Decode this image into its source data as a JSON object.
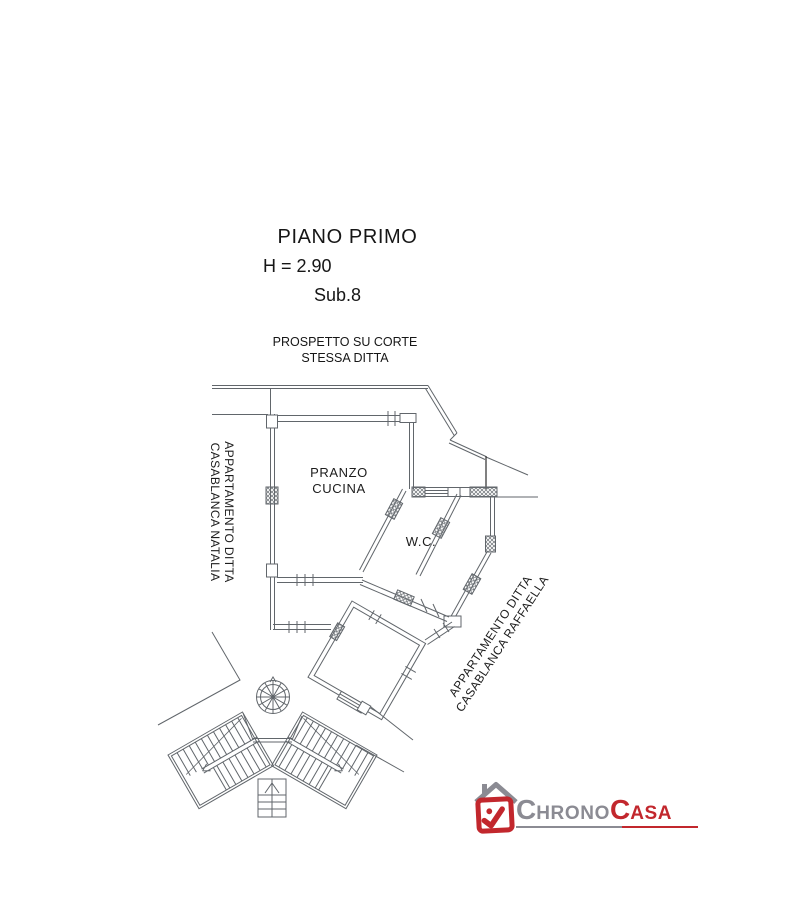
{
  "header": {
    "title": "PIANO PRIMO",
    "height_label": "H = 2.90",
    "sub_label": "Sub.8"
  },
  "plan": {
    "prospetto": {
      "line1": "PROSPETTO SU CORTE",
      "line2": "STESSA DITTA"
    },
    "rooms": {
      "kitchen_line1": "PRANZO",
      "kitchen_line2": "CUCINA",
      "wc": "W.C."
    },
    "apartment_left": {
      "line1": "APPARTAMENTO DITTA",
      "line2": "CASABLANCA NATALIA"
    },
    "apartment_right": {
      "line1": "APPARTAMENTO DITTA",
      "line2": "CASABLANCA RAFFAELLA"
    },
    "colors": {
      "line": "#61666b",
      "dark_line": "#2c2c2c",
      "text": "#1c1c1c"
    }
  },
  "logo": {
    "part1_initial": "C",
    "part1_rest": "HRONO",
    "part2_initial": "C",
    "part2_rest": "ASA",
    "colors": {
      "gray": "#8b8b93",
      "red": "#c2272d"
    },
    "icon": "house-checkmark"
  }
}
